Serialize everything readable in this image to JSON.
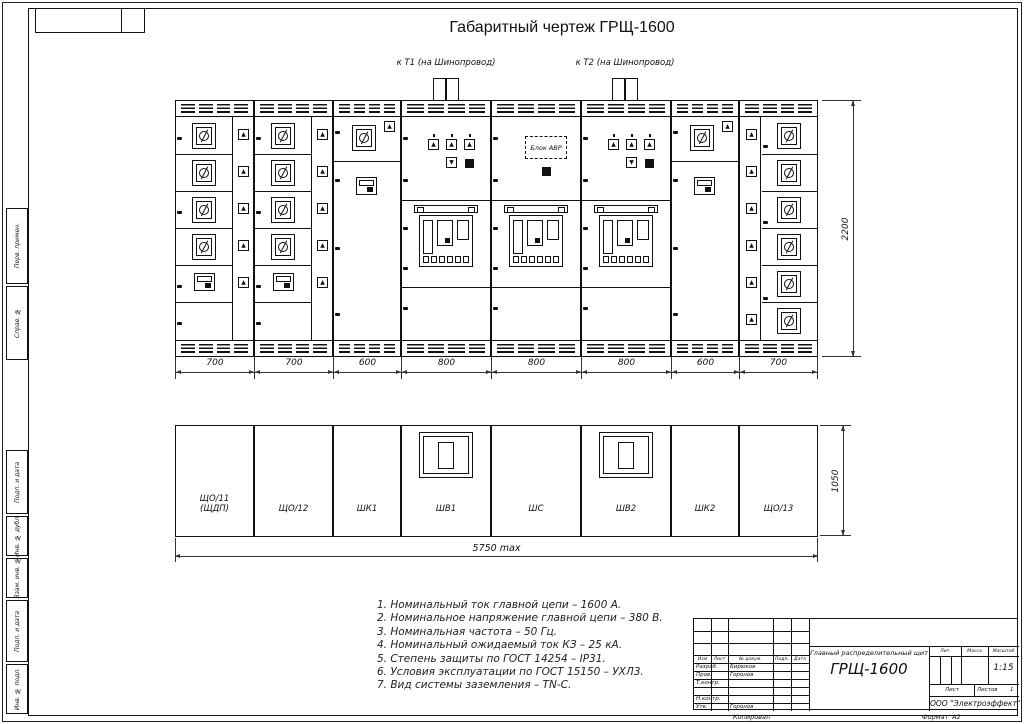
{
  "sheet": {
    "title": "Габаритный чертеж ГРЩ-1600"
  },
  "frame": {
    "side_labels": [
      "Перв. примен.",
      "Справ. №",
      "Подп. и дата",
      "Инв. № дубл.",
      "Взам. инв. №",
      "Подп. и дата",
      "Инв. № подл."
    ]
  },
  "front_view": {
    "feeder1": "к Т1 (на Шинопровод)",
    "feeder2": "к Т2 (на Шинопровод)",
    "avr_label": "Блок АВР",
    "height_dim": "2200",
    "panels": [
      {
        "type": "A",
        "width_mm": "700"
      },
      {
        "type": "A",
        "width_mm": "700"
      },
      {
        "type": "B",
        "width_mm": "600"
      },
      {
        "type": "C",
        "width_mm": "800"
      },
      {
        "type": "D",
        "width_mm": "800"
      },
      {
        "type": "C",
        "width_mm": "800"
      },
      {
        "type": "B",
        "width_mm": "600"
      },
      {
        "type": "E",
        "width_mm": "700"
      }
    ]
  },
  "plan_view": {
    "depth_dim": "1050",
    "total_dim": "5750 max",
    "cells": [
      {
        "line1": "ЩО/11",
        "line2": "(ЩДП)",
        "footprint": false
      },
      {
        "line1": "ЩО/12",
        "footprint": false
      },
      {
        "line1": "ШК1",
        "footprint": false
      },
      {
        "line1": "ШВ1",
        "footprint": true
      },
      {
        "line1": "ШС",
        "footprint": false
      },
      {
        "line1": "ШВ2",
        "footprint": true
      },
      {
        "line1": "ШК2",
        "footprint": false
      },
      {
        "line1": "ЩО/13",
        "footprint": false
      }
    ]
  },
  "notes": [
    "1. Номинальный ток главной цепи – 1600 А.",
    "2. Номинальное напряжение главной цепи – 380 В.",
    "3. Номинальная частота – 50 Гц.",
    "4. Номинальный ожидаемый ток КЗ – 25 кА.",
    "5. Степень защиты по ГОСТ 14254 – IP31.",
    "6. Условия эксплуатации по ГОСТ 15150 – УХЛ3.",
    "7. Вид системы заземления – TN-C."
  ],
  "title_block": {
    "header_cols": [
      "Изм",
      "Лист",
      "№ докум.",
      "Подп.",
      "Дата"
    ],
    "rows": [
      {
        "role": "Разраб.",
        "name": "Бирюков"
      },
      {
        "role": "Пров.",
        "name": "Горонов"
      },
      {
        "role": "Т.контр.",
        "name": ""
      },
      {
        "role": "",
        "name": ""
      },
      {
        "role": "Н.контр.",
        "name": ""
      },
      {
        "role": "Утв.",
        "name": "Горонов"
      }
    ],
    "doc_title_line1": "Главный распределительный щит",
    "doc_title_line2": "ГРЩ-1600",
    "lit_label": "Лит.",
    "mass_label": "Масса",
    "scale_label": "Масштаб",
    "scale_value": "1:15",
    "sheet_label": "Лист",
    "sheets_label": "Листов",
    "sheets_value": "1",
    "company": "ООО \"Электроэффект\"",
    "copied": "Копировал",
    "format_label": "Формат",
    "format_value": "А2"
  }
}
